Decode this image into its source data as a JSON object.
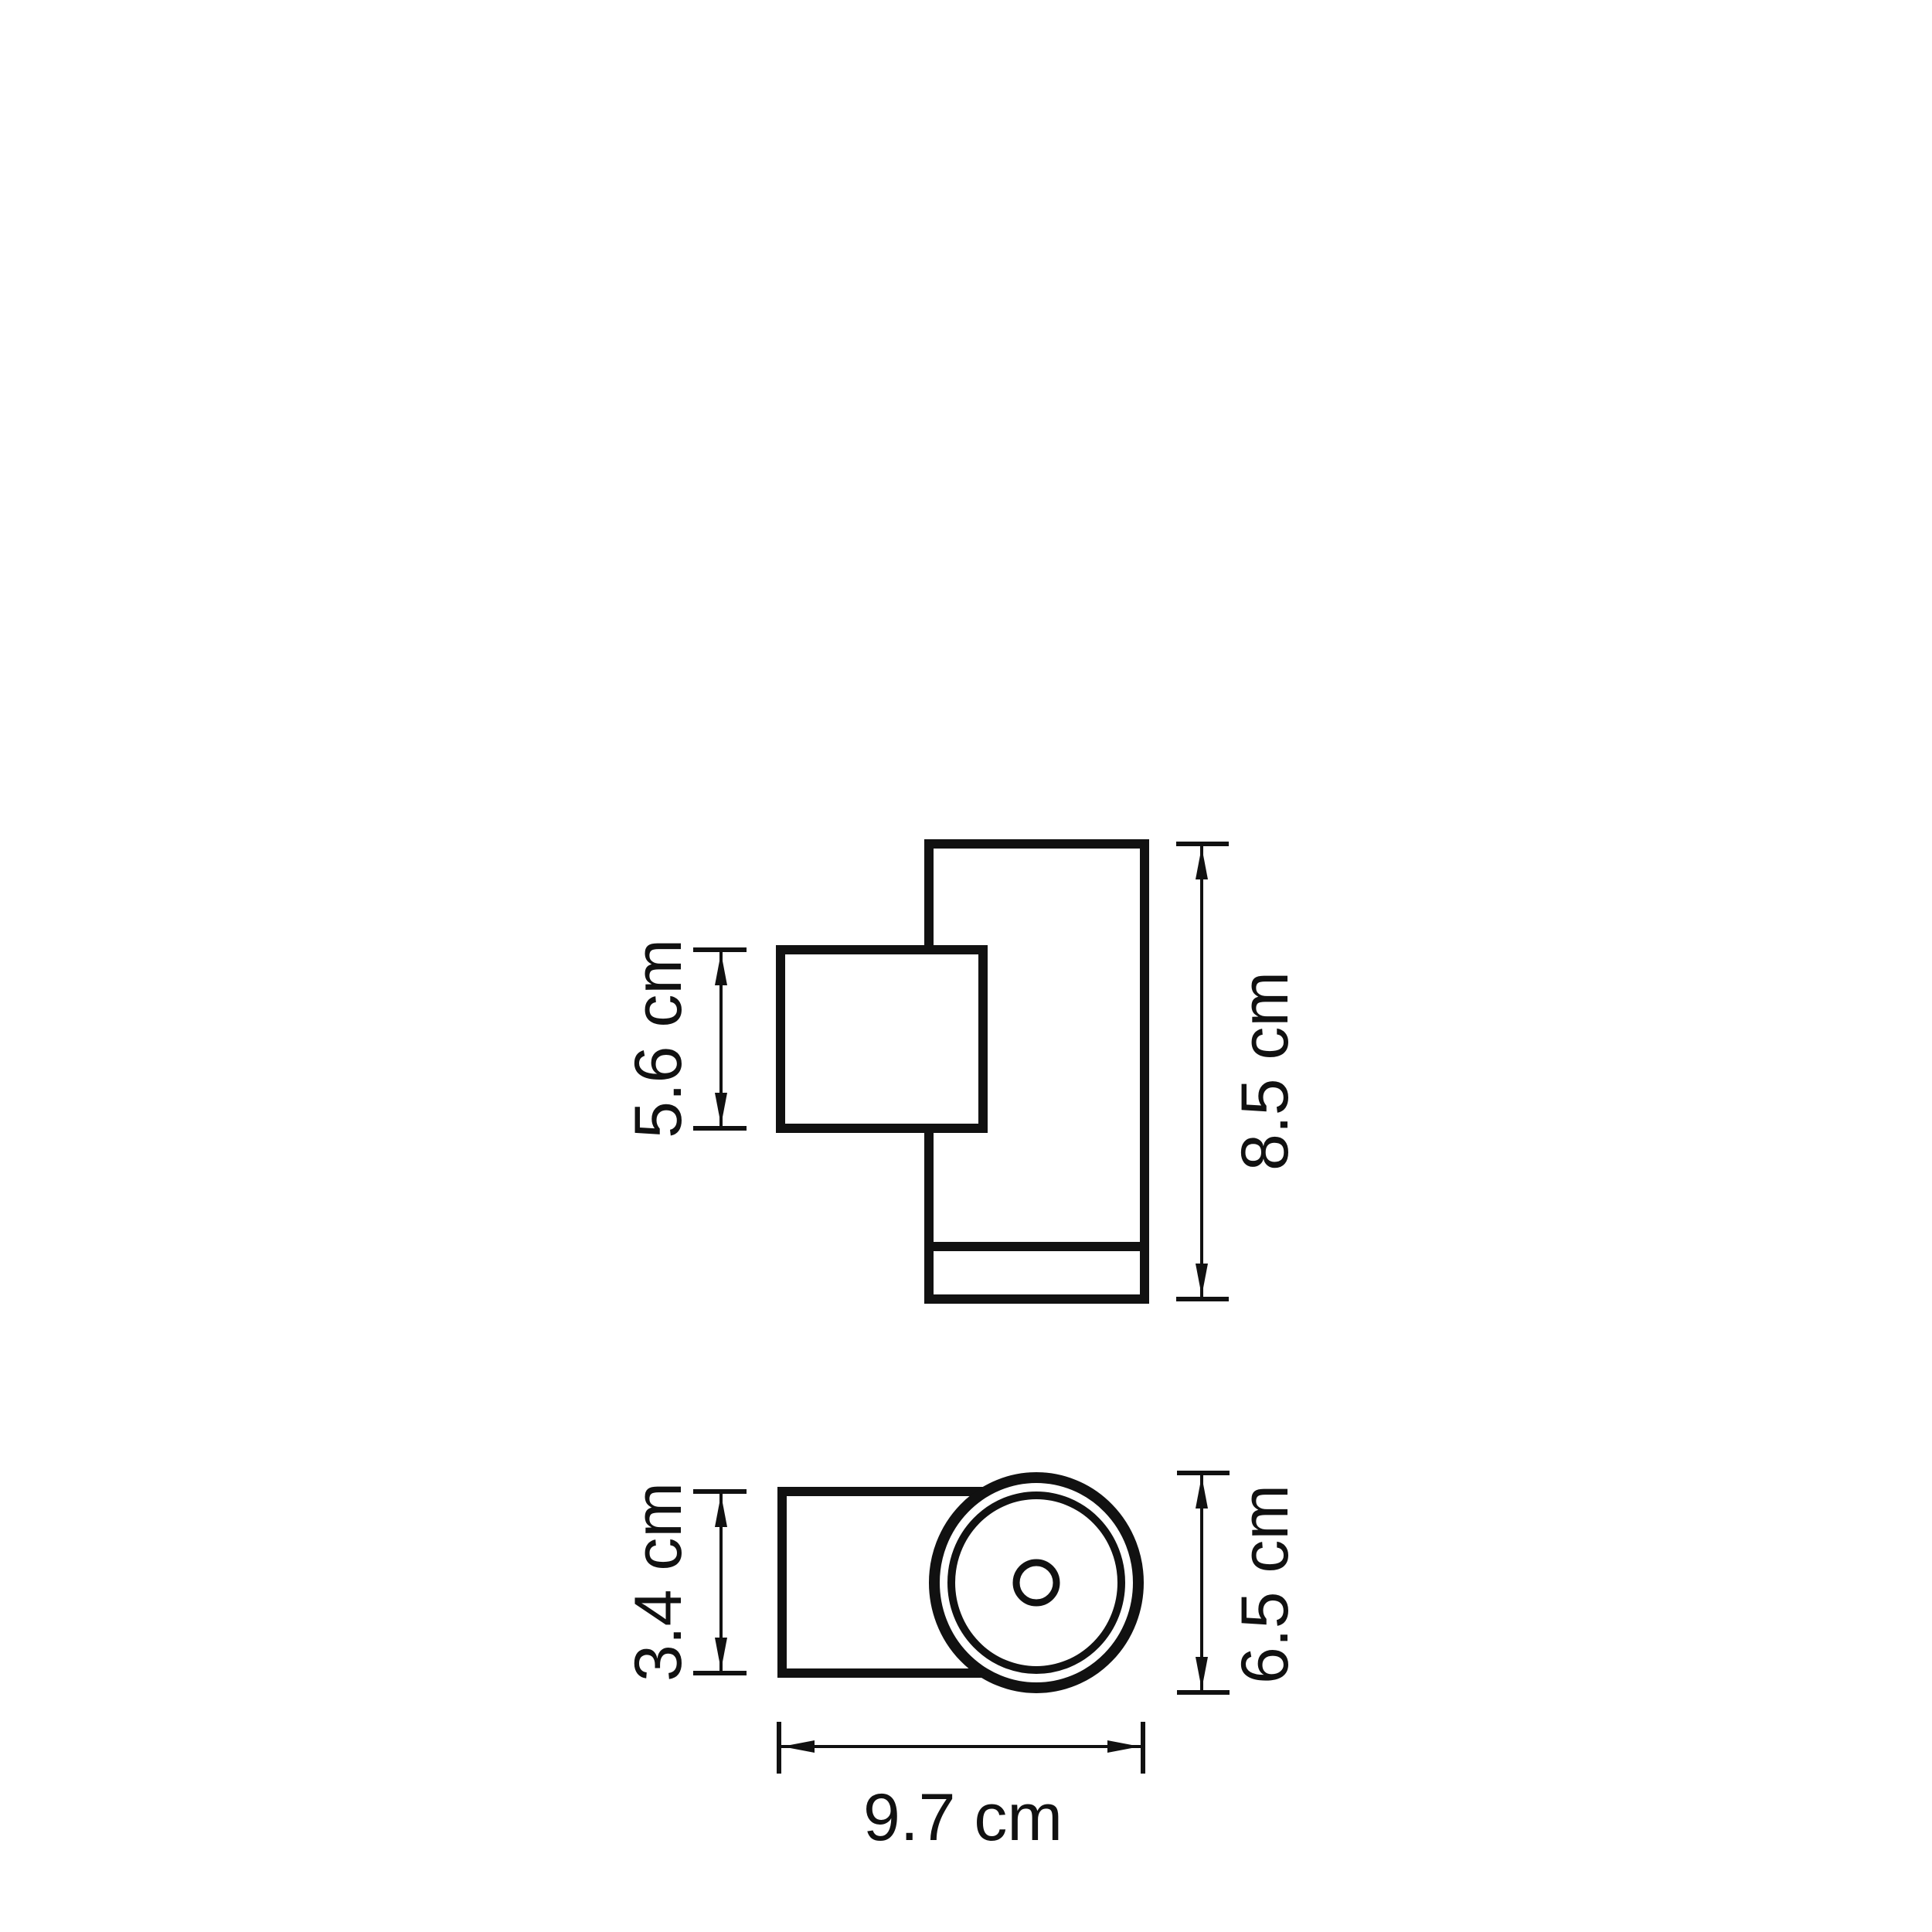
{
  "drawing": {
    "kind": "technical dimension drawing, two orthographic views of a cylindrical wall-mounted light fixture",
    "ink_color": "#111111",
    "background_color": "#ffffff",
    "unit": "cm"
  },
  "front_view": {
    "bracket_height": {
      "label": "5.6 cm",
      "value": 5.6,
      "unit": "cm",
      "orientation": "vertical",
      "side": "left"
    },
    "body_height": {
      "label": "8.5 cm",
      "value": 8.5,
      "unit": "cm",
      "orientation": "vertical",
      "side": "right"
    }
  },
  "top_view": {
    "bracket_depth": {
      "label": "3.4 cm",
      "value": 3.4,
      "unit": "cm",
      "orientation": "vertical",
      "side": "left"
    },
    "body_diameter": {
      "label": "6.5 cm",
      "value": 6.5,
      "unit": "cm",
      "orientation": "vertical",
      "side": "right"
    },
    "total_depth": {
      "label": "9.7 cm",
      "value": 9.7,
      "unit": "cm",
      "orientation": "horizontal",
      "side": "bottom"
    }
  }
}
